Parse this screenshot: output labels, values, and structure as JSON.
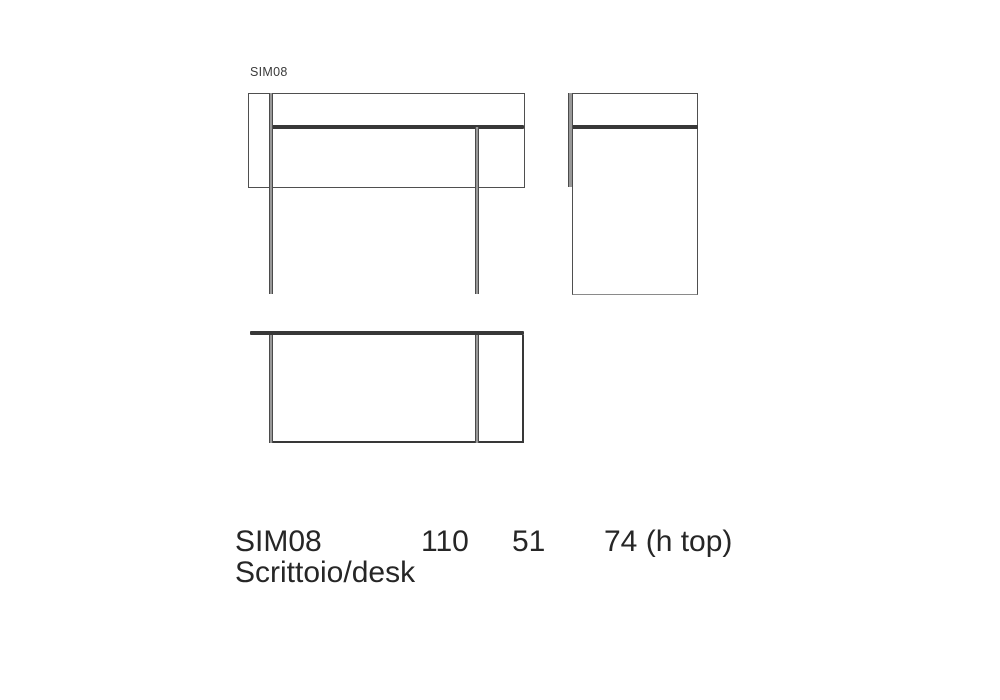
{
  "drawing_label": "SIM08",
  "spec": {
    "model": "SIM08",
    "description": "Scrittoio/desk",
    "width_cm": "110",
    "depth_cm": "51",
    "height_label": "74 (h top)"
  },
  "colors": {
    "background": "#ffffff",
    "outline": "#4f4f4f",
    "outline_light": "#8a8a8a",
    "desktop_line": "#383838",
    "leg_fill": "#999999",
    "leg_edge": "#4b4b4b",
    "text": "#262626",
    "label_text": "#3a3a3a"
  }
}
